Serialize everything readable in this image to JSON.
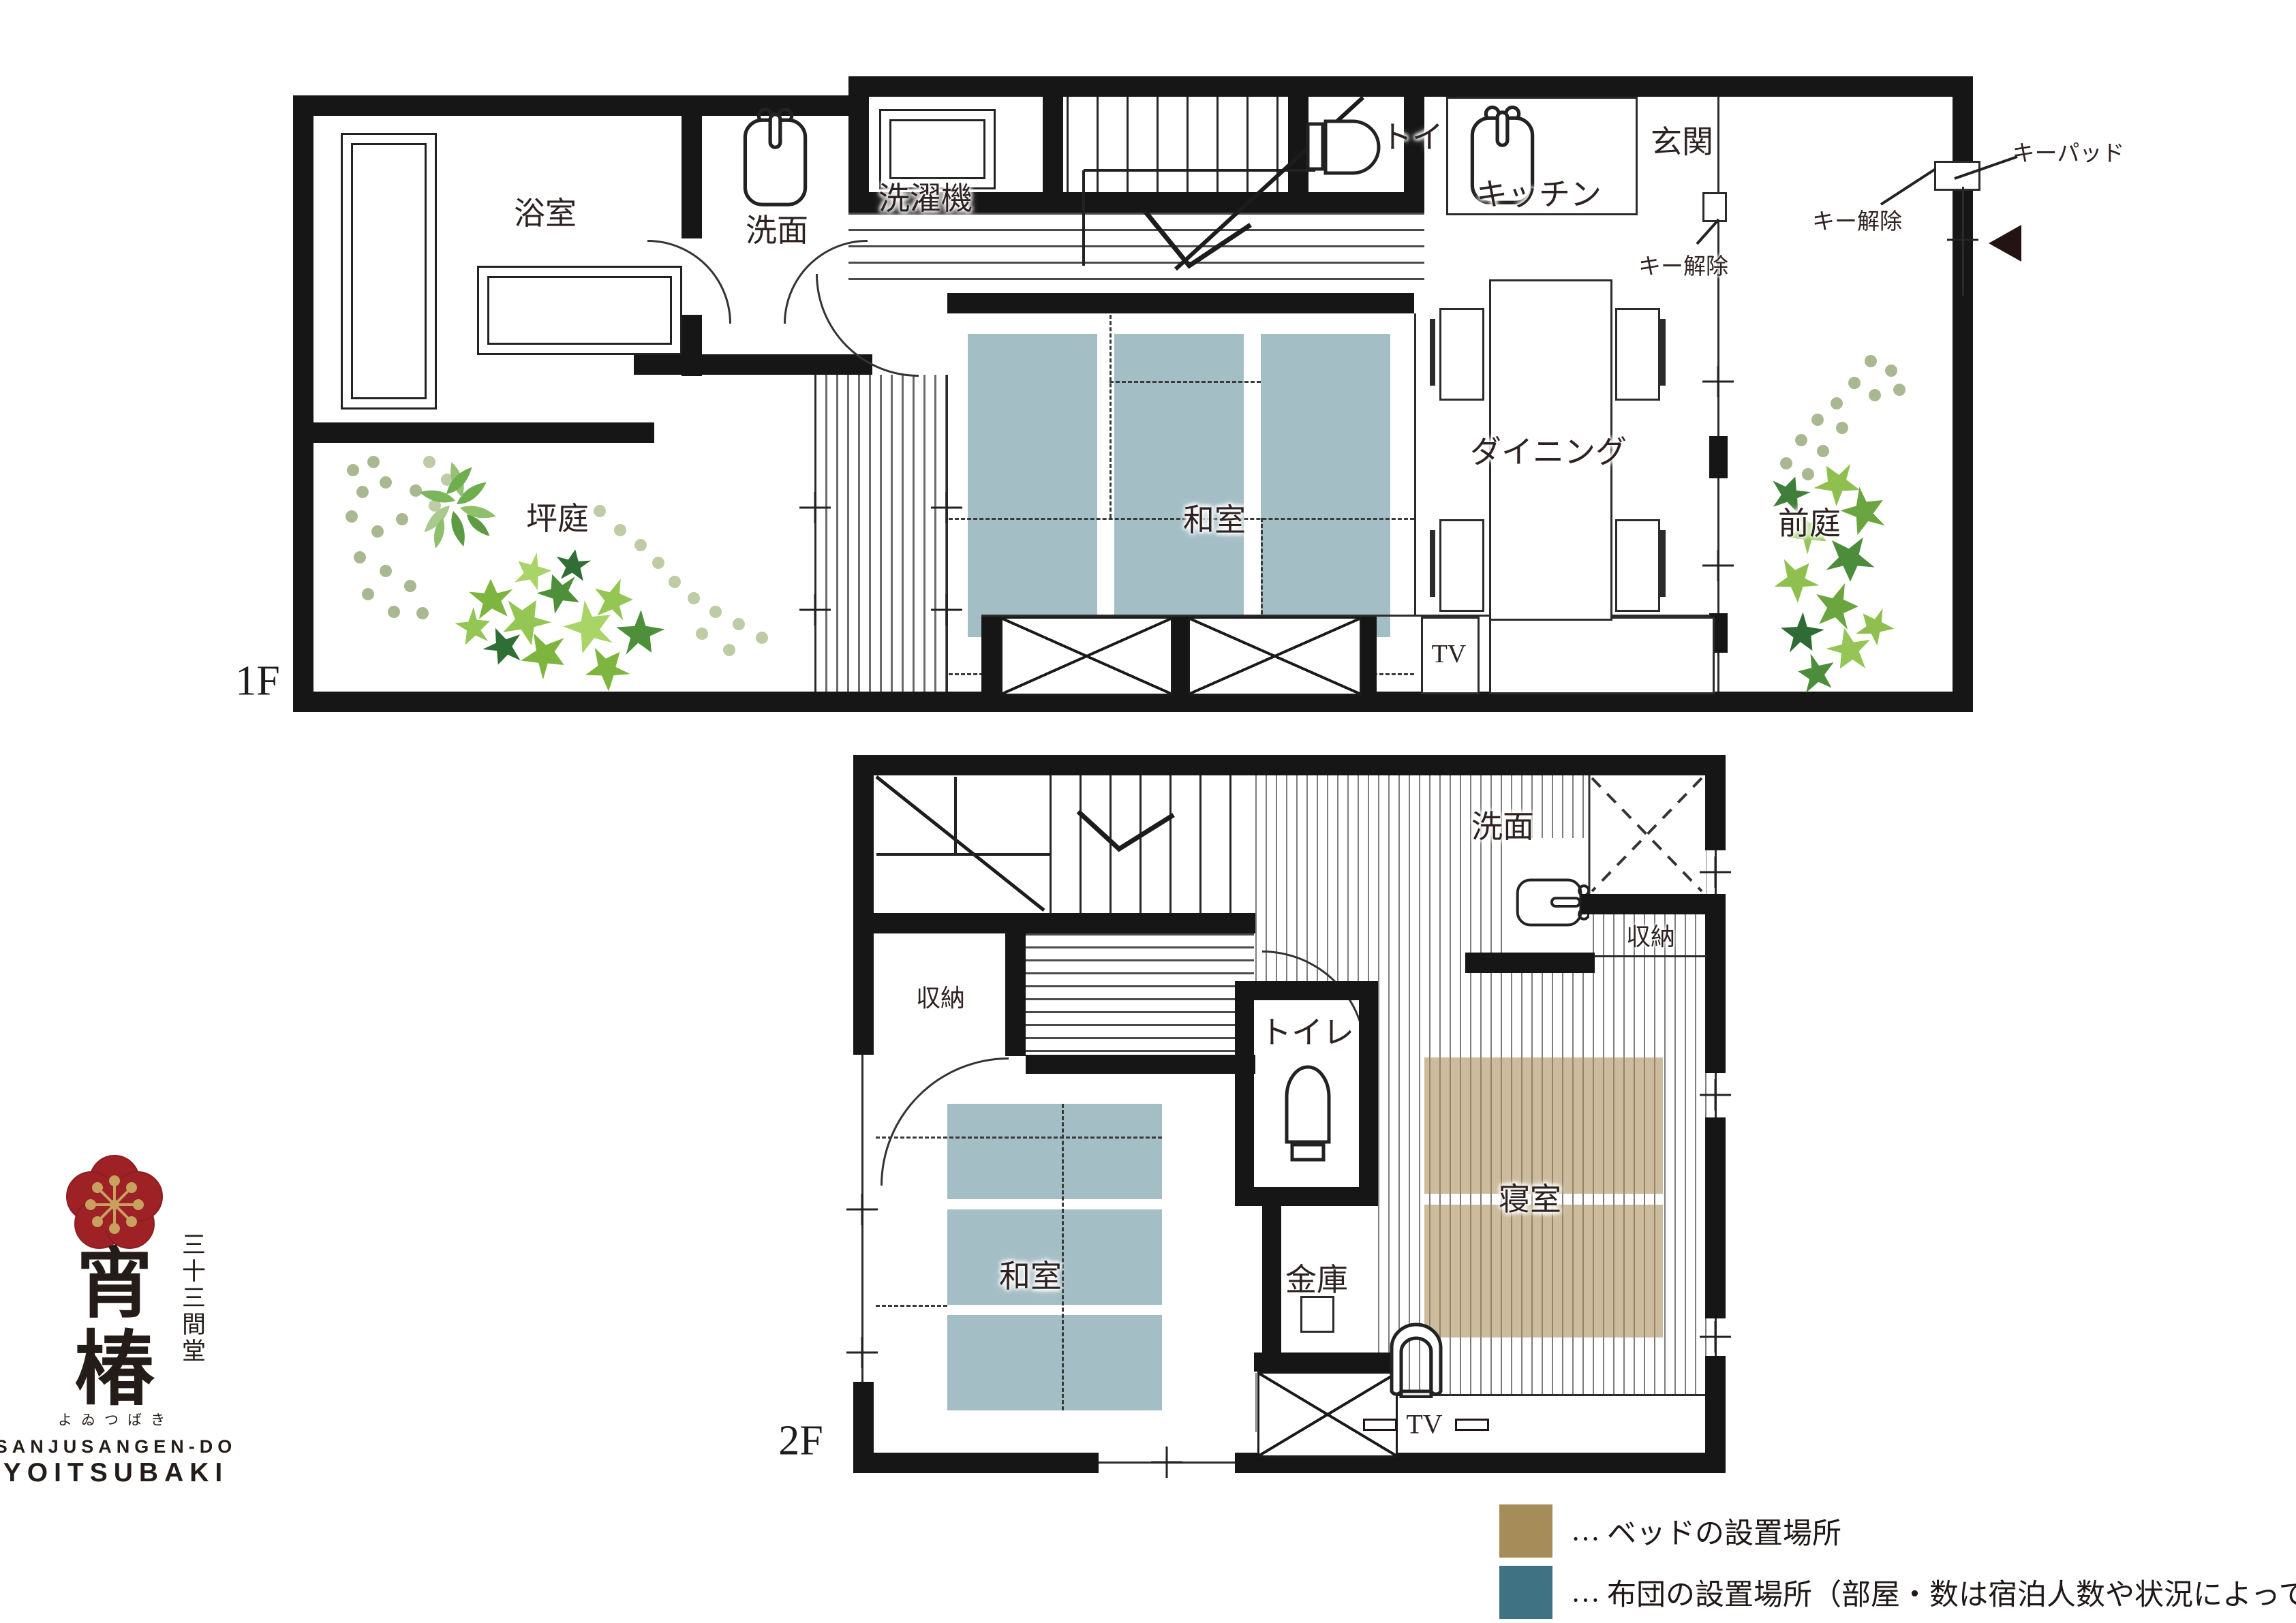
{
  "colors": {
    "wall": "#161616",
    "futon_plan": "#a4bec5",
    "bed_plan": "#b99f6e",
    "legend_bed": "#a68c58",
    "legend_futon": "#3f7282",
    "label_text": "#2e2121",
    "logo_red": "#9e2125",
    "logo_gold": "#c9a15f"
  },
  "floor1": {
    "label": "1F",
    "rooms": {
      "bath": "浴室",
      "washroom": "洗面",
      "washing_machine": "洗濯機",
      "toilet": "トイレ",
      "kitchen": "キッチン",
      "entrance": "玄関",
      "tatami_room": "和室",
      "dining": "ダイニング",
      "courtyard_garden": "坪庭",
      "front_garden": "前庭",
      "tv": "TV"
    },
    "annotations": {
      "keypad": "キーパッド",
      "key_release": "キー解除"
    }
  },
  "floor2": {
    "label": "2F",
    "rooms": {
      "storage_left": "収納",
      "storage_right": "収納",
      "washroom": "洗面",
      "toilet": "トイレ",
      "safe": "金庫",
      "tatami_room": "和室",
      "bedroom": "寝室",
      "tv": "TV"
    }
  },
  "legend": {
    "bed": {
      "ellipsis": "…",
      "label": "ベッドの設置場所"
    },
    "futon": {
      "ellipsis": "…",
      "label": "布団の設置場所（部屋・数は宿泊人数や状況によって異なります。）"
    }
  },
  "logo": {
    "hall_name_vertical": "三十三間堂",
    "brand_char_1": "宵",
    "brand_char_2": "椿",
    "furigana": "よゐつばき",
    "latin_1": "SANJUSANGEN-DO",
    "latin_2": "YOITSUBAKI"
  }
}
